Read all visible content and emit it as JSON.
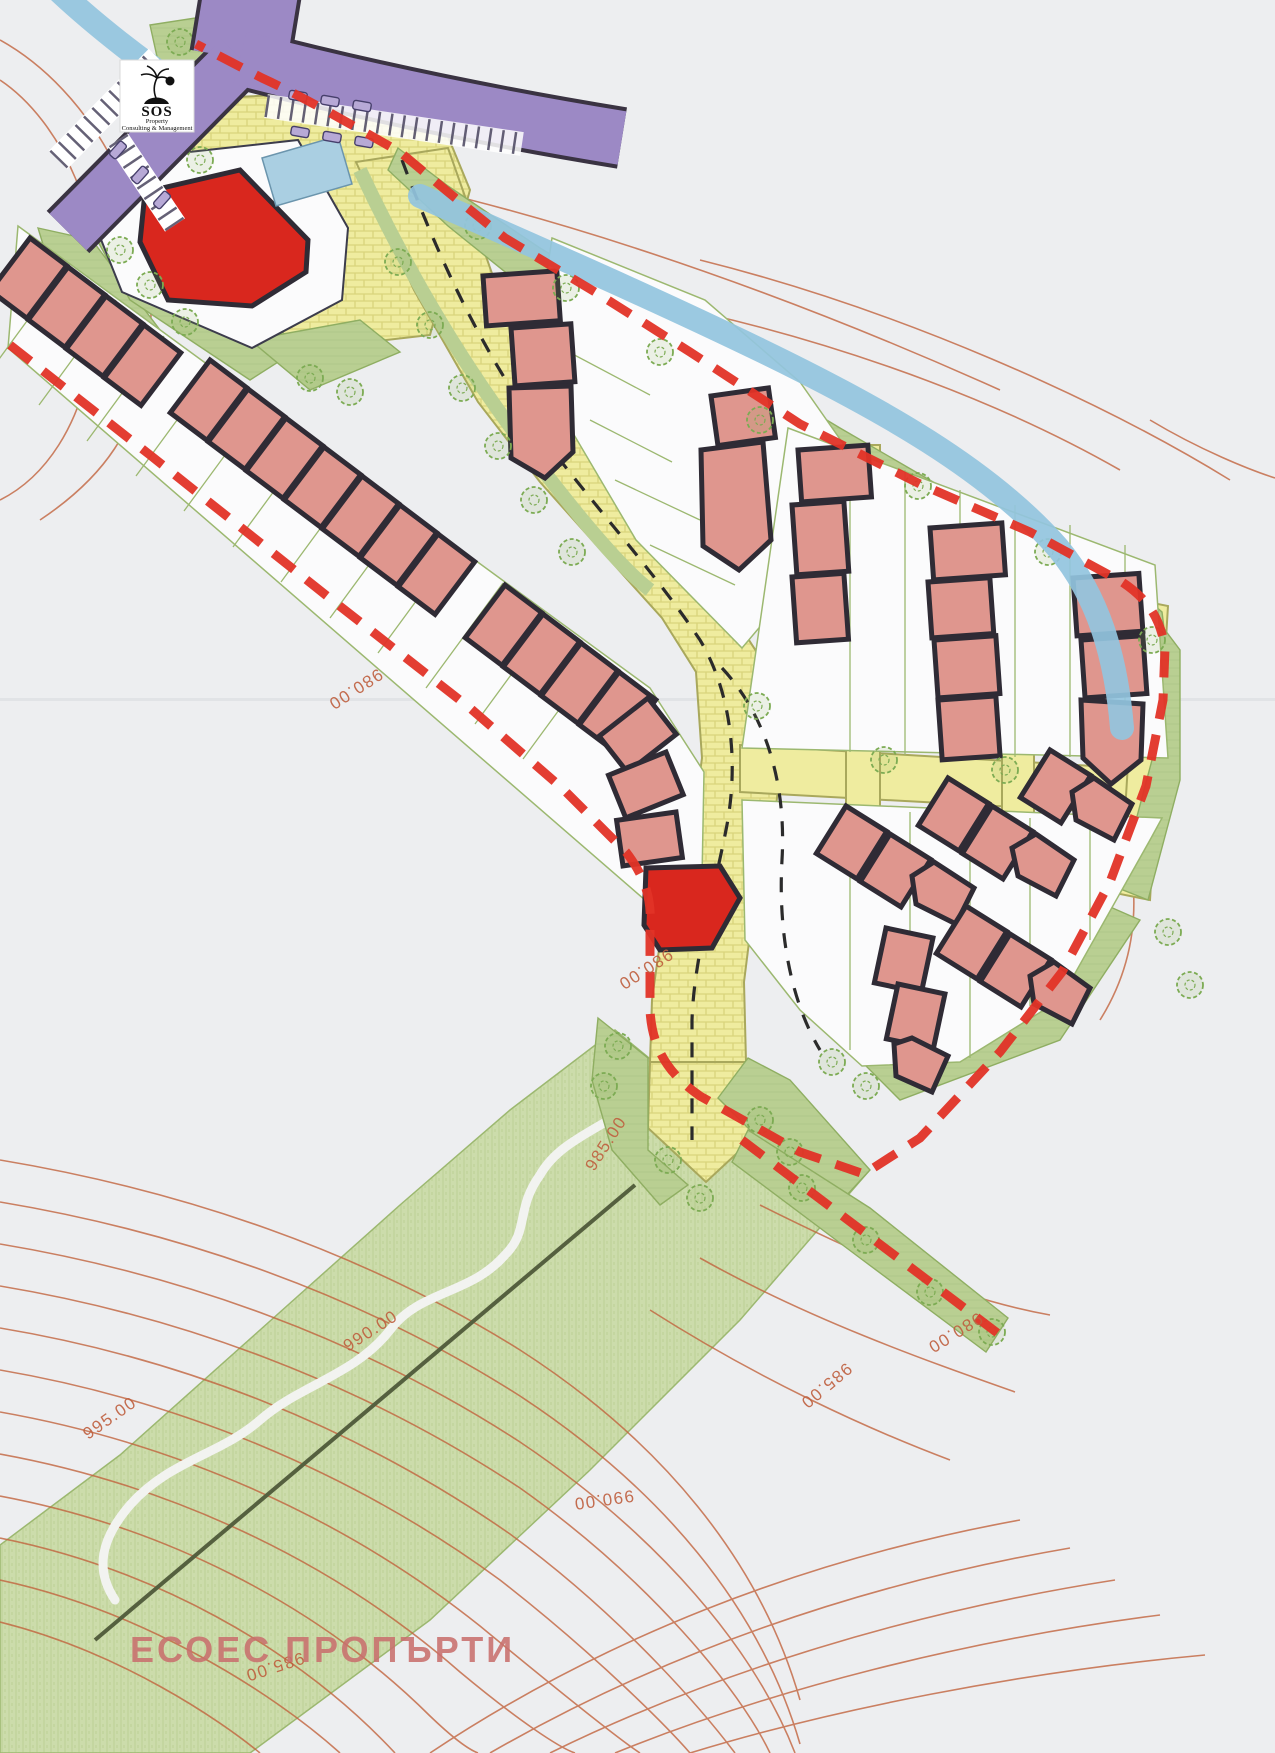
{
  "logo": {
    "brand": "SOS",
    "line1": "Property",
    "line2": "Consulting & Management",
    "icon": "palm-tree-icon"
  },
  "title": {
    "text": "ЕСОЕС ПРОПЪРТИ"
  },
  "contour_labels": [
    {
      "text": "980.00",
      "x": 378,
      "y": 668,
      "rot": 147
    },
    {
      "text": "980.00",
      "x": 668,
      "y": 948,
      "rot": 147
    },
    {
      "text": "985.00",
      "x": 594,
      "y": 1172,
      "rot": -57
    },
    {
      "text": "990.00",
      "x": 348,
      "y": 1352,
      "rot": -33
    },
    {
      "text": "995.00",
      "x": 88,
      "y": 1440,
      "rot": -35
    },
    {
      "text": "980.00",
      "x": 978,
      "y": 1312,
      "rot": 148
    },
    {
      "text": "985.00",
      "x": 846,
      "y": 1362,
      "rot": 140
    },
    {
      "text": "990.00",
      "x": 633,
      "y": 1490,
      "rot": 172
    },
    {
      "text": "985.00",
      "x": 302,
      "y": 1652,
      "rot": 162
    }
  ],
  "palette": {
    "paper": "#edeef0",
    "meadow_green": "#ccdcab",
    "site_green": "#b9cf92",
    "road_yellow": "#efec9f",
    "brick_line": "#d9d47c",
    "building_fill": "#df968e",
    "building_outline": "#2f2b35",
    "accent_building_red": "#d9271e",
    "purple_road": "#9c89c5",
    "river_blue": "#93c4de",
    "pool_blue": "#aacfe2",
    "boundary_red": "#e23327",
    "contour_line": "#c2643e",
    "plot_outline": "#9cb870",
    "title_pink": "#c9706e"
  },
  "layers": {
    "boundary": "red dashed property boundary",
    "roads": "yellow paved internal roads with dashed centerlines",
    "access_road": "purple public road with parking bays",
    "water": "river and pool",
    "terrain": "contour lines 980.00 - 995.00",
    "landscape": "green strips and meadow with trees"
  }
}
